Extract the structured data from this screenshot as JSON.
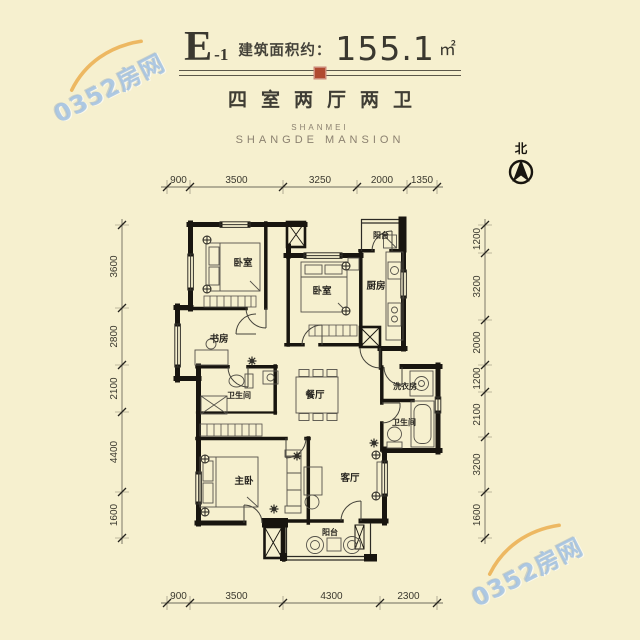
{
  "header": {
    "plan_code": "E",
    "plan_code_sub": "-1",
    "area_label": "建筑面积约：",
    "area_value": "155.1",
    "area_unit": "㎡",
    "layout_type": "四室两厅两卫",
    "brand_line1": "SHANMEI",
    "brand_line2": "SHANGDE MANSION"
  },
  "compass": {
    "label": "北"
  },
  "watermark": {
    "text": "0352房网"
  },
  "colors": {
    "background": "#f6f0cf",
    "wall": "#18150f",
    "seal_red": "#b04a30",
    "watermark_blue": "#a0c0e0",
    "watermark_orange": "#e9a63e",
    "dimension_text": "#3b392f"
  },
  "floor_plan": {
    "rooms": [
      {
        "name": "bedroom-top-left",
        "label": "卧室"
      },
      {
        "name": "bedroom-middle",
        "label": "卧室"
      },
      {
        "name": "balcony-top",
        "label": "阳台"
      },
      {
        "name": "kitchen",
        "label": "厨房"
      },
      {
        "name": "study",
        "label": "书房"
      },
      {
        "name": "bathroom-left",
        "label": "卫生间"
      },
      {
        "name": "dining-room",
        "label": "餐厅"
      },
      {
        "name": "laundry-room",
        "label": "洗衣房"
      },
      {
        "name": "bathroom-right",
        "label": "卫生间"
      },
      {
        "name": "master-bedroom",
        "label": "主卧"
      },
      {
        "name": "living-room",
        "label": "客厅"
      },
      {
        "name": "balcony-bottom",
        "label": "阳台"
      }
    ],
    "dimensions": {
      "top": [
        "900",
        "3500",
        "3250",
        "2000",
        "1350"
      ],
      "bottom": [
        "900",
        "3500",
        "4300",
        "2300"
      ],
      "left": [
        "3600",
        "2800",
        "2100",
        "4400",
        "1600"
      ],
      "right": [
        "1200",
        "3200",
        "2000",
        "1200",
        "2100",
        "3200",
        "1600"
      ]
    }
  }
}
